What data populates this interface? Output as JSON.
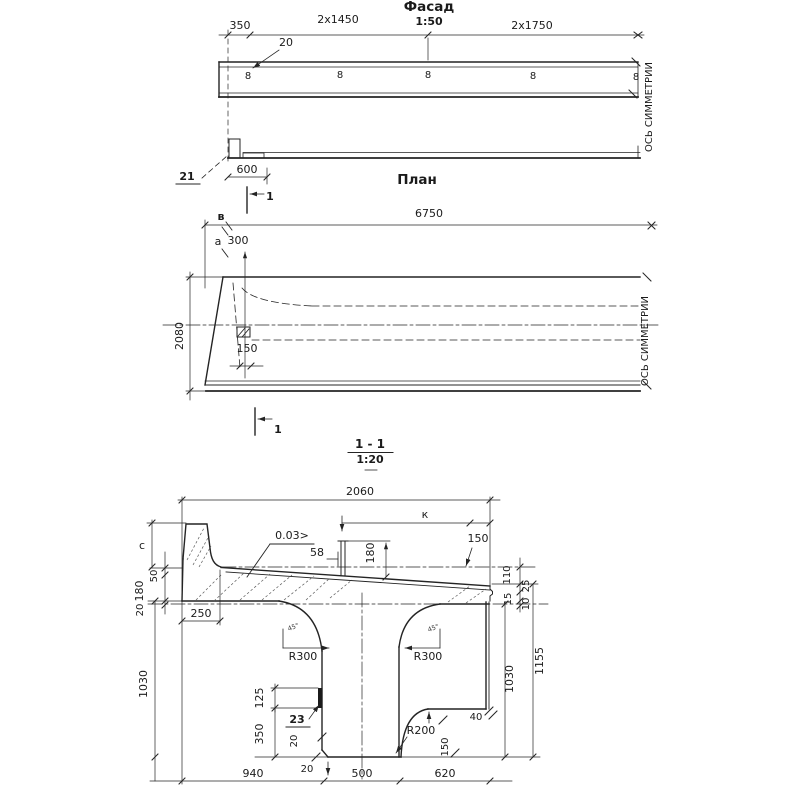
{
  "facade": {
    "title": "Фасад",
    "scale": "1:50",
    "dim_350": "350",
    "dim_2x1450": "2x1450",
    "dim_2x1750": "2x1750",
    "callout_20": "20",
    "dim_600": "600",
    "callout_21": "21",
    "loops": [
      "8",
      "8",
      "8",
      "8",
      "8"
    ],
    "axis_label": "ОСЬ СИММЕТРИИ"
  },
  "plan": {
    "title": "План",
    "dim_6750": "6750",
    "dim_300": "300",
    "dim_150": "150",
    "dim_2080": "2080",
    "label_v": "в",
    "label_a": "а",
    "section_mark": "1",
    "axis_label": "ОСЬ СИММЕТРИИ"
  },
  "section": {
    "title": "1 - 1",
    "scale": "1:20",
    "dim_width": "2060",
    "dim_k": "к",
    "slope": "0.03>",
    "dim_58": "58",
    "dim_180_post": "180",
    "dim_150_top": "150",
    "dim_c": "с",
    "dim_50": "50",
    "dim_180_left": "180",
    "dim_20_left": "20",
    "dim_250": "250",
    "dim_1030_left": "1030",
    "r300_left": "R300",
    "r300_right": "R300",
    "angle_left": "45°",
    "angle_right": "45°",
    "dim_125": "125",
    "plate_23": "23",
    "dim_350": "350",
    "dim_20_a": "20",
    "dim_20_b": "20",
    "dim_940": "940",
    "dim_500": "500",
    "dim_620": "620",
    "dim_110": "110",
    "dim_25": "25",
    "dim_15": "15",
    "dim_10": "10",
    "dim_1030_right": "1030",
    "dim_1155": "1155",
    "r200": "R200",
    "dim_40": "40",
    "dim_150_step": "150"
  }
}
